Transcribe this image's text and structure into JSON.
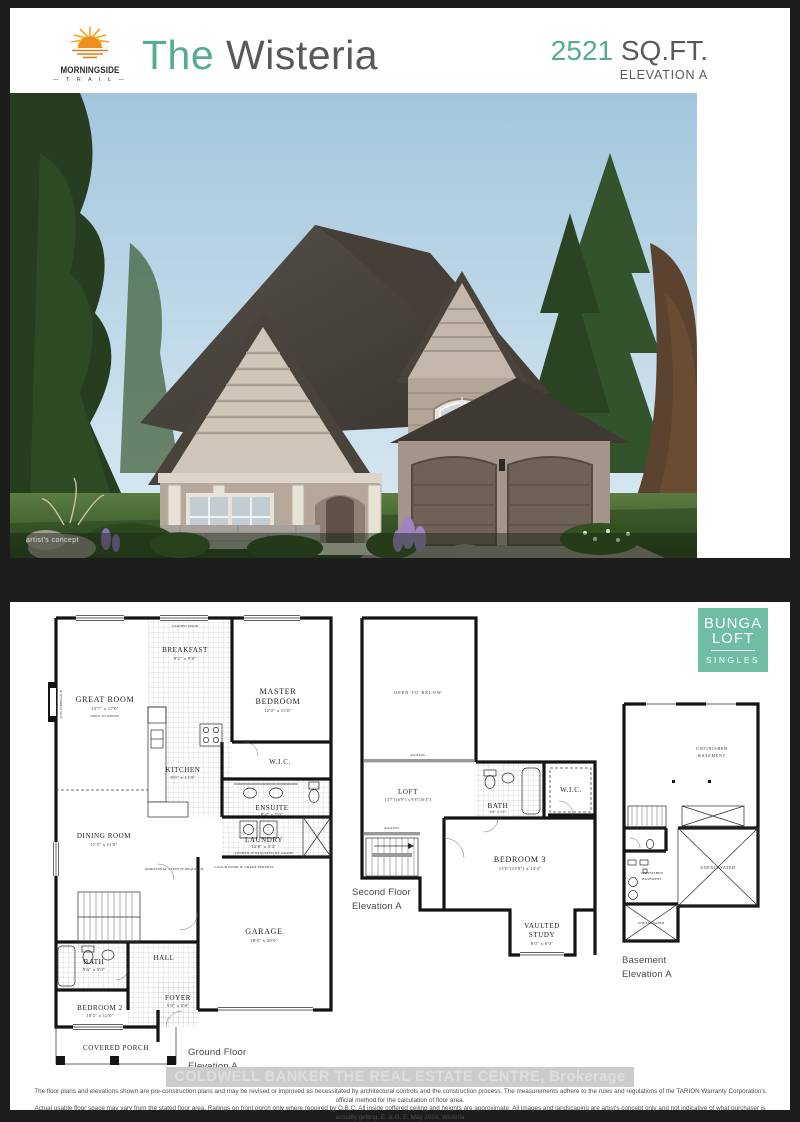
{
  "colors": {
    "page_bg": "#1d1d1e",
    "accent_teal": "#53ac93",
    "badge_teal": "#6fbda4",
    "logo_orange": "#f2a31b",
    "title_gray": "#58595a"
  },
  "header": {
    "logo": {
      "line1": "MORNINGSIDE",
      "line2": "T R A I L"
    },
    "title": {
      "prefix": "The ",
      "name": "Wisteria"
    },
    "sqft": {
      "value": "2521",
      "unit": " SQ.FT.",
      "elevation": "ELEVATION A"
    }
  },
  "hero": {
    "caption": "artist's concept"
  },
  "badge": {
    "line1": "BUNGA",
    "line2": "LOFT",
    "line3": "SINGLES"
  },
  "plans": {
    "ground": {
      "caption1": "Ground Floor",
      "caption2": "Elevation A",
      "rooms": {
        "great_room": {
          "name": "GREAT ROOM",
          "dims": "13'7\" x 17'0\"",
          "note": "OPEN TO ABOVE"
        },
        "breakfast": {
          "name": "BREAKFAST",
          "dims": "9'2\" x 9'8\"",
          "note": "GARDEN DOOR"
        },
        "master": {
          "line1": "MASTER",
          "line2": "BEDROOM",
          "dims": "12'0\" x 15'0\""
        },
        "kitchen": {
          "name": "KITCHEN",
          "dims": "9'0\" x 11'0\""
        },
        "wic": {
          "name": "W.I.C."
        },
        "ensuite": {
          "name": "ENSUITE",
          "dims": "8'4\" x 5'0\""
        },
        "dining": {
          "name": "DINING ROOM",
          "dims": "11'3\" x 11'0\""
        },
        "laundry": {
          "name": "LAUNDRY",
          "dims": "12'8\" x 5'4\"",
          "note": "SUNKEN IF REQUIRED BY GRADE"
        },
        "bath": {
          "name": "BATH",
          "dims": "9'6\" x 5'0\""
        },
        "hall": {
          "name": "HALL"
        },
        "foyer": {
          "name": "FOYER",
          "dims": "5'0\" x 6'8\""
        },
        "bedroom2": {
          "name": "BEDROOM 2",
          "dims": "10'2\" x 12'0\""
        },
        "garage": {
          "name": "GARAGE",
          "dims": "18'4\" x 20'0\""
        },
        "porch": {
          "name": "COVERED PORCH"
        }
      },
      "notes": {
        "coach_door": "COACH DOOR IF GRADE PERMITS",
        "steps": "ADDITIONAL STEPS IF REQUIRED",
        "fireplace": "GAS FIREPLACE"
      }
    },
    "second": {
      "caption1": "Second Floor",
      "caption2": "Elevation A",
      "rooms": {
        "open_below": {
          "name": "OPEN TO BELOW"
        },
        "railing": {
          "name": "RAILING"
        },
        "loft": {
          "name": "LOFT",
          "dims": "13'7\"(16'9\") x 9'8\"(16'4\")"
        },
        "bath": {
          "name": "BATH",
          "dims": "8'0\" x 5'0\""
        },
        "wic": {
          "name": "W.I.C."
        },
        "bedroom3": {
          "name": "BEDROOM 3",
          "dims": "15'0\"(13'0\") x 14'4\""
        },
        "study": {
          "line1": "VAULTED",
          "line2": "STUDY",
          "dims": "8'0\" x 6'0\""
        }
      }
    },
    "basement": {
      "caption1": "Basement",
      "caption2": "Elevation A",
      "rooms": {
        "unfinished": {
          "line1": "UNFINISHED",
          "line2": "BASEMENT"
        },
        "unexcavated": {
          "name": "UNEXCAVATED"
        }
      }
    }
  },
  "watermark": "COLDWELL BANKER THE REAL ESTATE CENTRE, Brokerage",
  "disclaimer": {
    "line1": "The floor plans and elevations shown are pre-construction plans and may be revised or improved as necessitated by architectural controls and the construction process. The measurements adhere to the rules and regulations of the TARION Warranty Corporation's official method for the calculation of floor area.",
    "line2": "Actual usable floor space may vary from the stated floor area. Railings on front porch only where required by O.B.C. All inside coffered ceiling and heights are approximate. All images and landscaping are artist's concept only and not indicative of what purchaser is actually getting. E. & O. E. May 2024.  Wisteria"
  }
}
